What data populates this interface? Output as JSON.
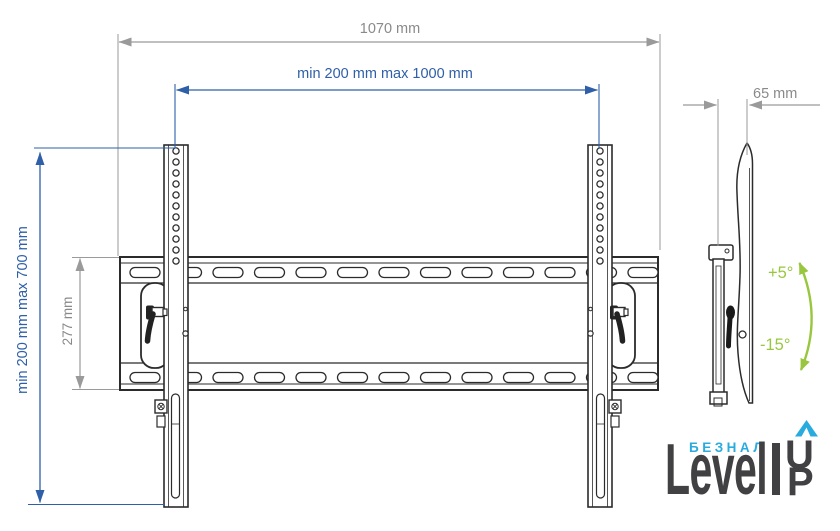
{
  "diagram": {
    "front_view": {
      "total_width_label": "1070 mm",
      "vesa_width_label": "min 200 mm max 1000 mm",
      "vesa_height_label": "min 200 mm max 700 mm",
      "plate_height_label": "277 mm"
    },
    "side_view": {
      "depth_label": "65 mm",
      "tilt_up_label": "+5°",
      "tilt_down_label": "-15°"
    }
  },
  "logo": {
    "tagline": "БЕЗНАЛ",
    "wordmark": "Level",
    "up_u": "U",
    "up_p": "P"
  },
  "colors": {
    "drawing_line": "#2b2b2b",
    "dimension_gray": "#9a9a9a",
    "dimension_blue": "#2e5fa8",
    "tilt_green": "#98c73f",
    "logo_cyan": "#2aabdf",
    "logo_dark": "#414042"
  }
}
